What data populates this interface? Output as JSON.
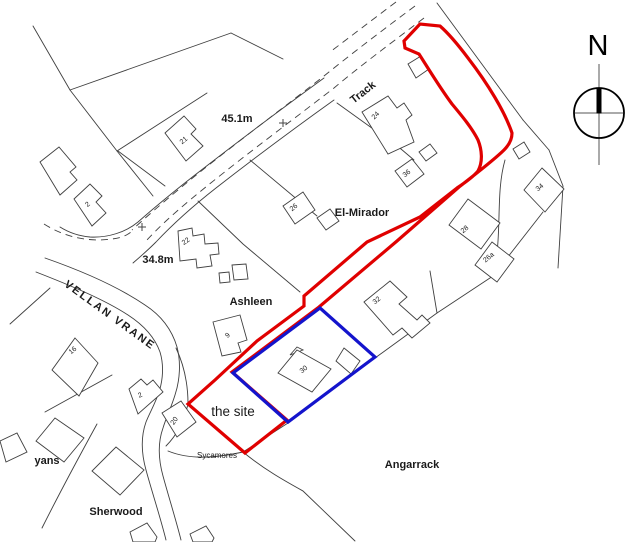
{
  "map": {
    "colors": {
      "site_boundary": "#e00000",
      "ownership_boundary": "#1414cc",
      "linework": "#3f3f3f",
      "building_fill": "#ffffff"
    },
    "compass": {
      "letter": "N"
    },
    "site_label_color": "#e00000",
    "labels": [
      {
        "id": "height-451",
        "text": "45.1m",
        "x": 237,
        "y": 122,
        "r": 0,
        "cls": "place"
      },
      {
        "id": "track",
        "text": "Track",
        "x": 365,
        "y": 95,
        "r": -38,
        "cls": "place"
      },
      {
        "id": "el-mirador",
        "text": "El-Mirador",
        "x": 362,
        "y": 216,
        "r": 0,
        "cls": "place"
      },
      {
        "id": "height-348",
        "text": "34.8m",
        "x": 158,
        "y": 263,
        "r": 0,
        "cls": "place"
      },
      {
        "id": "ashleen",
        "text": "Ashleen",
        "x": 251,
        "y": 305,
        "r": 0,
        "cls": "place"
      },
      {
        "id": "vellan-vrane",
        "text": "VELLAN VRANE",
        "x": 108,
        "y": 318,
        "r": 36,
        "cls": "road"
      },
      {
        "id": "the-site",
        "text": "the site",
        "x": 233,
        "y": 416,
        "r": 0,
        "cls": "site"
      },
      {
        "id": "sycamores",
        "text": "Sycamores",
        "x": 217,
        "y": 458,
        "r": 0,
        "cls": "small"
      },
      {
        "id": "yans",
        "text": "yans",
        "x": 47,
        "y": 464,
        "r": 0,
        "cls": "place"
      },
      {
        "id": "sherwood",
        "text": "Sherwood",
        "x": 116,
        "y": 515,
        "r": 0,
        "cls": "place"
      },
      {
        "id": "angarrack",
        "text": "Angarrack",
        "x": 412,
        "y": 468,
        "r": 0,
        "cls": "place"
      },
      {
        "id": "house-21",
        "text": "21",
        "x": 185,
        "y": 142,
        "r": -40,
        "cls": "house"
      },
      {
        "id": "house-24",
        "text": "24",
        "x": 377,
        "y": 117,
        "r": -45,
        "cls": "house"
      },
      {
        "id": "house-36",
        "text": "36",
        "x": 408,
        "y": 175,
        "r": -40,
        "cls": "house"
      },
      {
        "id": "house-26",
        "text": "26",
        "x": 295,
        "y": 209,
        "r": -40,
        "cls": "house"
      },
      {
        "id": "house-22",
        "text": "22",
        "x": 187,
        "y": 243,
        "r": -35,
        "cls": "house"
      },
      {
        "id": "house-2-upper",
        "text": "2",
        "x": 89,
        "y": 206,
        "r": -40,
        "cls": "house"
      },
      {
        "id": "house-9",
        "text": "9",
        "x": 229,
        "y": 337,
        "r": -40,
        "cls": "house"
      },
      {
        "id": "house-16",
        "text": "16",
        "x": 74,
        "y": 352,
        "r": -40,
        "cls": "house"
      },
      {
        "id": "house-2-lower",
        "text": "2",
        "x": 141,
        "y": 397,
        "r": -25,
        "cls": "house"
      },
      {
        "id": "house-20",
        "text": "20",
        "x": 176,
        "y": 422,
        "r": -55,
        "cls": "house"
      },
      {
        "id": "house-30",
        "text": "30",
        "x": 305,
        "y": 371,
        "r": -40,
        "cls": "house"
      },
      {
        "id": "house-32",
        "text": "32",
        "x": 378,
        "y": 302,
        "r": -40,
        "cls": "house"
      },
      {
        "id": "house-28",
        "text": "28",
        "x": 466,
        "y": 231,
        "r": -40,
        "cls": "house"
      },
      {
        "id": "house-26a",
        "text": "26a",
        "x": 490,
        "y": 259,
        "r": -40,
        "cls": "house"
      },
      {
        "id": "house-34",
        "text": "34",
        "x": 541,
        "y": 189,
        "r": -40,
        "cls": "house"
      }
    ],
    "benchmarks": [
      {
        "x": 283,
        "y": 123
      },
      {
        "x": 142,
        "y": 227
      }
    ]
  }
}
